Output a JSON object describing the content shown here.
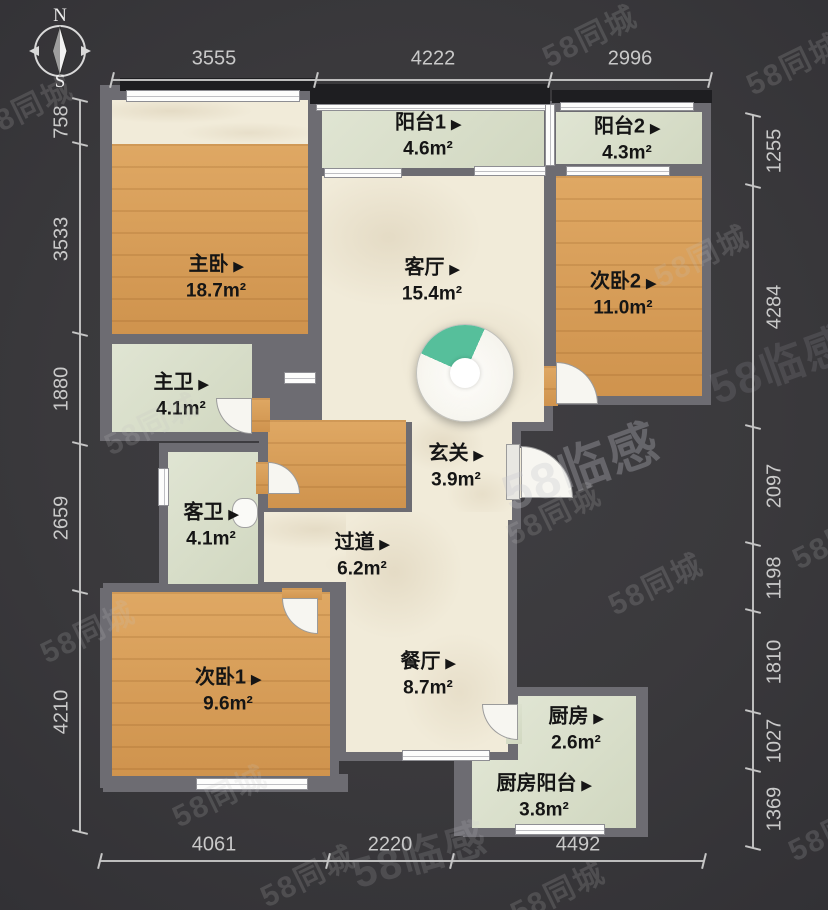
{
  "compass": {
    "north_label": "N",
    "south_label": "S"
  },
  "ui": {
    "label_marker": "▶"
  },
  "watermark": {
    "small": "58同城",
    "brand": "58临感"
  },
  "rooms": [
    {
      "name": "主卧",
      "area": "18.7m²"
    },
    {
      "name": "阳台1",
      "area": "4.6m²"
    },
    {
      "name": "阳台2",
      "area": "4.3m²"
    },
    {
      "name": "客厅",
      "area": "15.4m²"
    },
    {
      "name": "次卧2",
      "area": "11.0m²"
    },
    {
      "name": "主卫",
      "area": "4.1m²"
    },
    {
      "name": "客卫",
      "area": "4.1m²"
    },
    {
      "name": "玄关",
      "area": "3.9m²"
    },
    {
      "name": "过道",
      "area": "6.2m²"
    },
    {
      "name": "次卧1",
      "area": "9.6m²"
    },
    {
      "name": "餐厅",
      "area": "8.7m²"
    },
    {
      "name": "厨房",
      "area": "2.6m²"
    },
    {
      "name": "厨房阳台",
      "area": "3.8m²"
    }
  ],
  "dimensions": {
    "top": [
      "3555",
      "4222",
      "2996"
    ],
    "left": [
      "758",
      "3533",
      "1880",
      "2659",
      "4210"
    ],
    "right": [
      "1255",
      "4284",
      "2097",
      "1198",
      "1810",
      "1027",
      "1369"
    ],
    "bottom": [
      "4061",
      "2220",
      "4492"
    ]
  },
  "colors": {
    "wood": "#d99c54",
    "sage": "#d9dfc9",
    "cream": "#f1ebd9",
    "wall": "#6d6c72",
    "background": "#39383b",
    "viewpoint_green": "#56bf9b",
    "dimension_text": "#c9c9c9"
  }
}
